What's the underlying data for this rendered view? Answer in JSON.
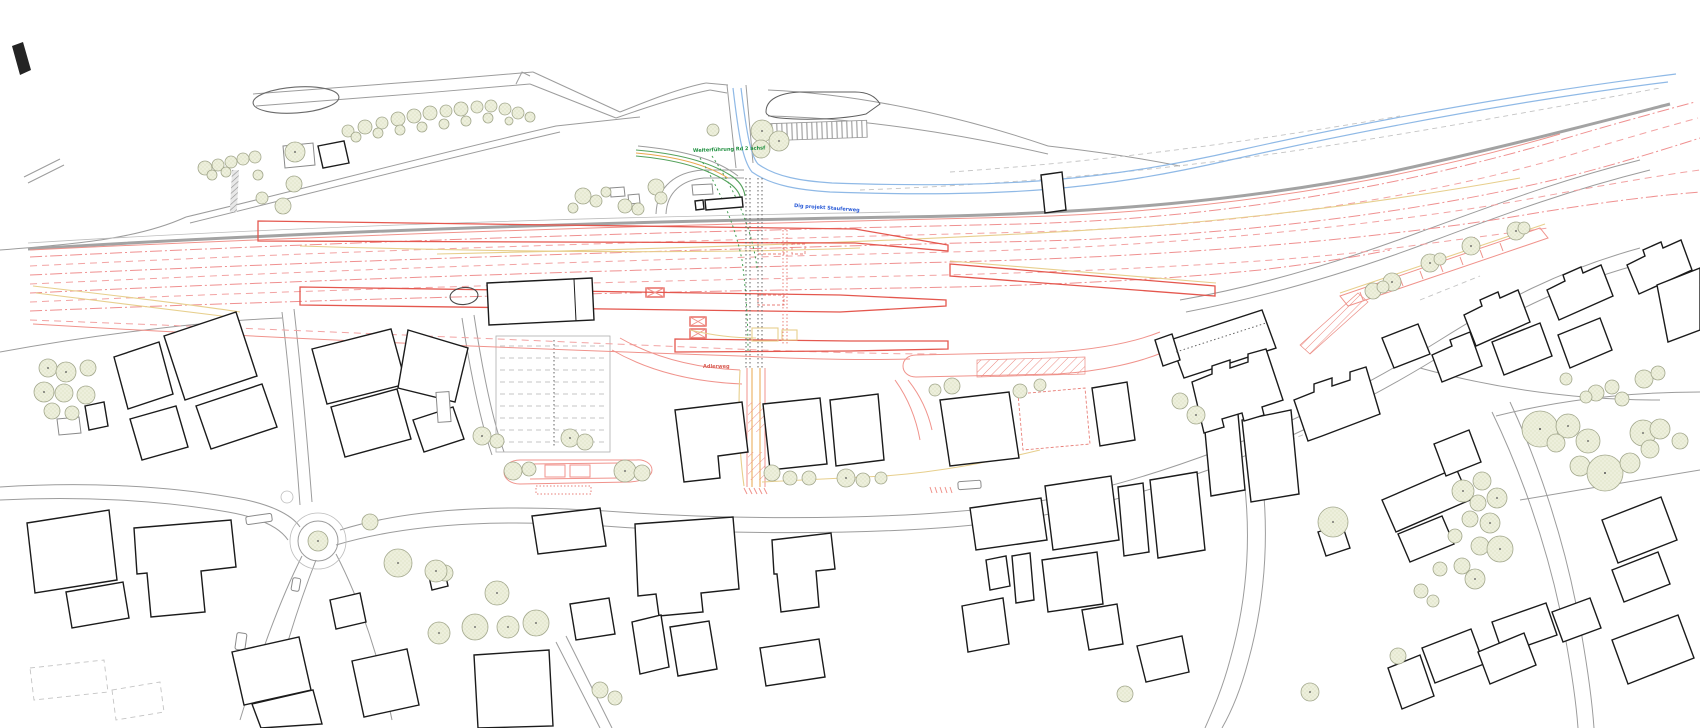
{
  "labels": {
    "green_note": "Weiterführung Rd 2 achsf",
    "blue_note": "Dig projekt Stauferweg",
    "red_note": "Adlerweg"
  },
  "colors": {
    "building_outline": "#1b1b1b",
    "road_gray": "#9c9c9c",
    "rail_corridor_gray": "#a3a3a3",
    "track_red_dashed": "#f2a3a3",
    "platform_red": "#e4574e",
    "accent_yellow": "#e7cf8d",
    "path_green": "#55a25c",
    "water_blue": "#8fb9e6",
    "tree_fill": "#edefdc",
    "note_green": "#1f8f3f",
    "note_blue": "#2a5bd7",
    "note_red": "#d96057"
  }
}
